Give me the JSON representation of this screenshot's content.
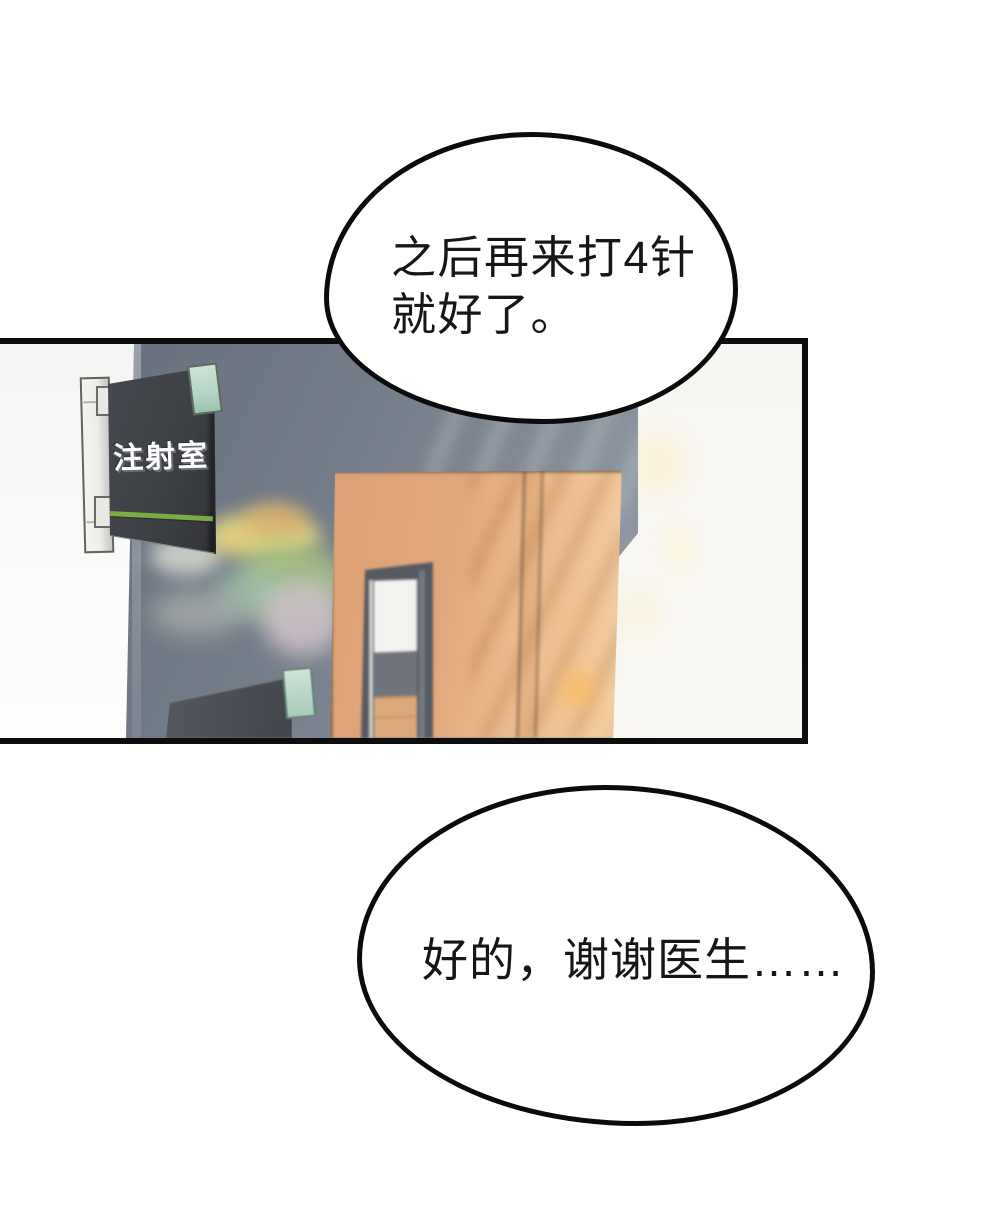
{
  "page": {
    "type": "comic-page",
    "background": "#ffffff"
  },
  "bubbles": {
    "doctor": {
      "text": "之后再来打4针\n就好了。"
    },
    "patient": {
      "text": "好的，谢谢医生……"
    }
  },
  "scene": {
    "sign": {
      "label": "注射室"
    },
    "palette": {
      "panel_border": "#0d0d0d",
      "bubble_border": "#0b0b0b",
      "wall_dark": "#737c89",
      "wall_white_left": "#f8f8f6",
      "wall_white_right": "#f7f5f1",
      "wall_orange": "#e2a87d",
      "sign_board": "#3e4146",
      "sign_text": "#ffffff",
      "sign_stripe_green": "#7cab45",
      "mint_tab": "#b7d8c7",
      "door_frame": "#565b63",
      "picture_frame": "#c7c9c7",
      "picture_glass": "#e9ede2",
      "floor": "#eeece5",
      "sun_flare": "#f8bd60"
    }
  }
}
